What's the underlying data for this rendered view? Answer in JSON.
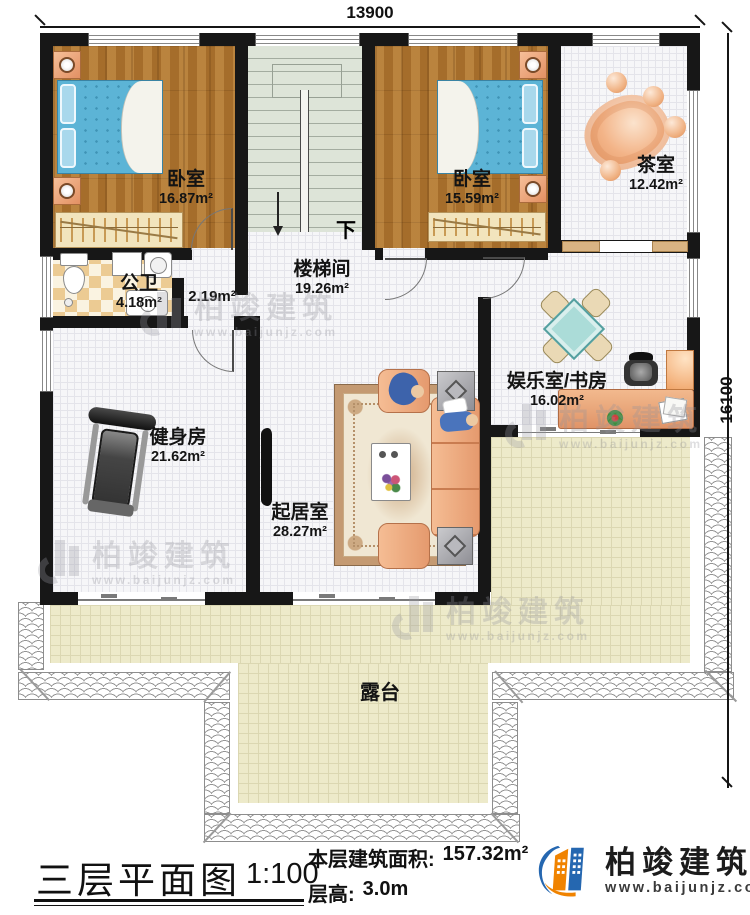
{
  "dimensions": {
    "width_mm": "13900",
    "height_mm": "16100"
  },
  "rooms": {
    "bedroom1": {
      "name": "卧室",
      "area": "16.87m²"
    },
    "bedroom2": {
      "name": "卧室",
      "area": "15.59m²"
    },
    "tea_room": {
      "name": "茶室",
      "area": "12.42m²"
    },
    "stairwell": {
      "name": "楼梯间",
      "area": "19.26m²"
    },
    "hallway": {
      "area": "2.19m²"
    },
    "bathroom": {
      "name": "公卫",
      "area": "4.18m²"
    },
    "gym": {
      "name": "健身房",
      "area": "21.62m²"
    },
    "living_room": {
      "name": "起居室",
      "area": "28.27m²"
    },
    "entertainment_study": {
      "name": "娱乐室/书房",
      "area": "16.02m²"
    },
    "terrace": {
      "name": "露台"
    }
  },
  "stairs": {
    "down_label": "下"
  },
  "title_block": {
    "title": "三层平面图",
    "scale": "1:100",
    "area_label": "本层建筑面积:",
    "area_value": "157.32m²",
    "height_label": "层高:",
    "height_value": "3.0m"
  },
  "brand": {
    "name": "柏竣建筑",
    "website": "www.baijunjz.com",
    "navy": "#1c4a8c",
    "blue": "#2567b0",
    "orange": "#f08300"
  },
  "watermark": {
    "name": "柏竣建筑",
    "website": "www.baijunjz.com"
  }
}
